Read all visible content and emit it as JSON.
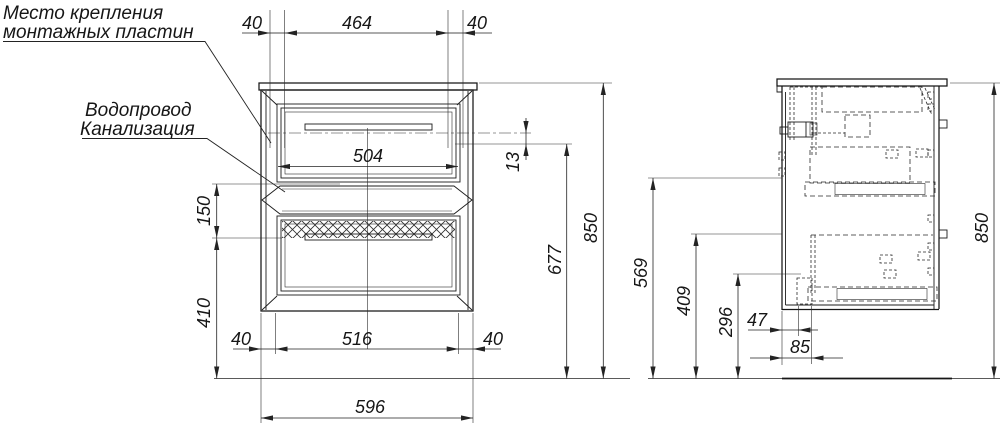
{
  "annotations": {
    "mounting_plates_line1": "Место крепления",
    "mounting_plates_line2": "монтажных пластин",
    "plumbing_line1": "Водопровод",
    "plumbing_line2": "Канализация"
  },
  "front_view": {
    "dims": {
      "top_left_40": "40",
      "top_464": "464",
      "top_right_40": "40",
      "inner_504": "504",
      "offset_13": "13",
      "height_677": "677",
      "height_850": "850",
      "left_150": "150",
      "left_410": "410",
      "bottom_left_40": "40",
      "bottom_516": "516",
      "bottom_right_40": "40",
      "width_596": "596"
    }
  },
  "side_view": {
    "dims": {
      "height_850": "850",
      "h_569": "569",
      "h_409": "409",
      "h_296": "296",
      "w_47": "47",
      "w_85": "85"
    }
  },
  "colors": {
    "line": "#1c1c1c",
    "background": "#ffffff"
  }
}
